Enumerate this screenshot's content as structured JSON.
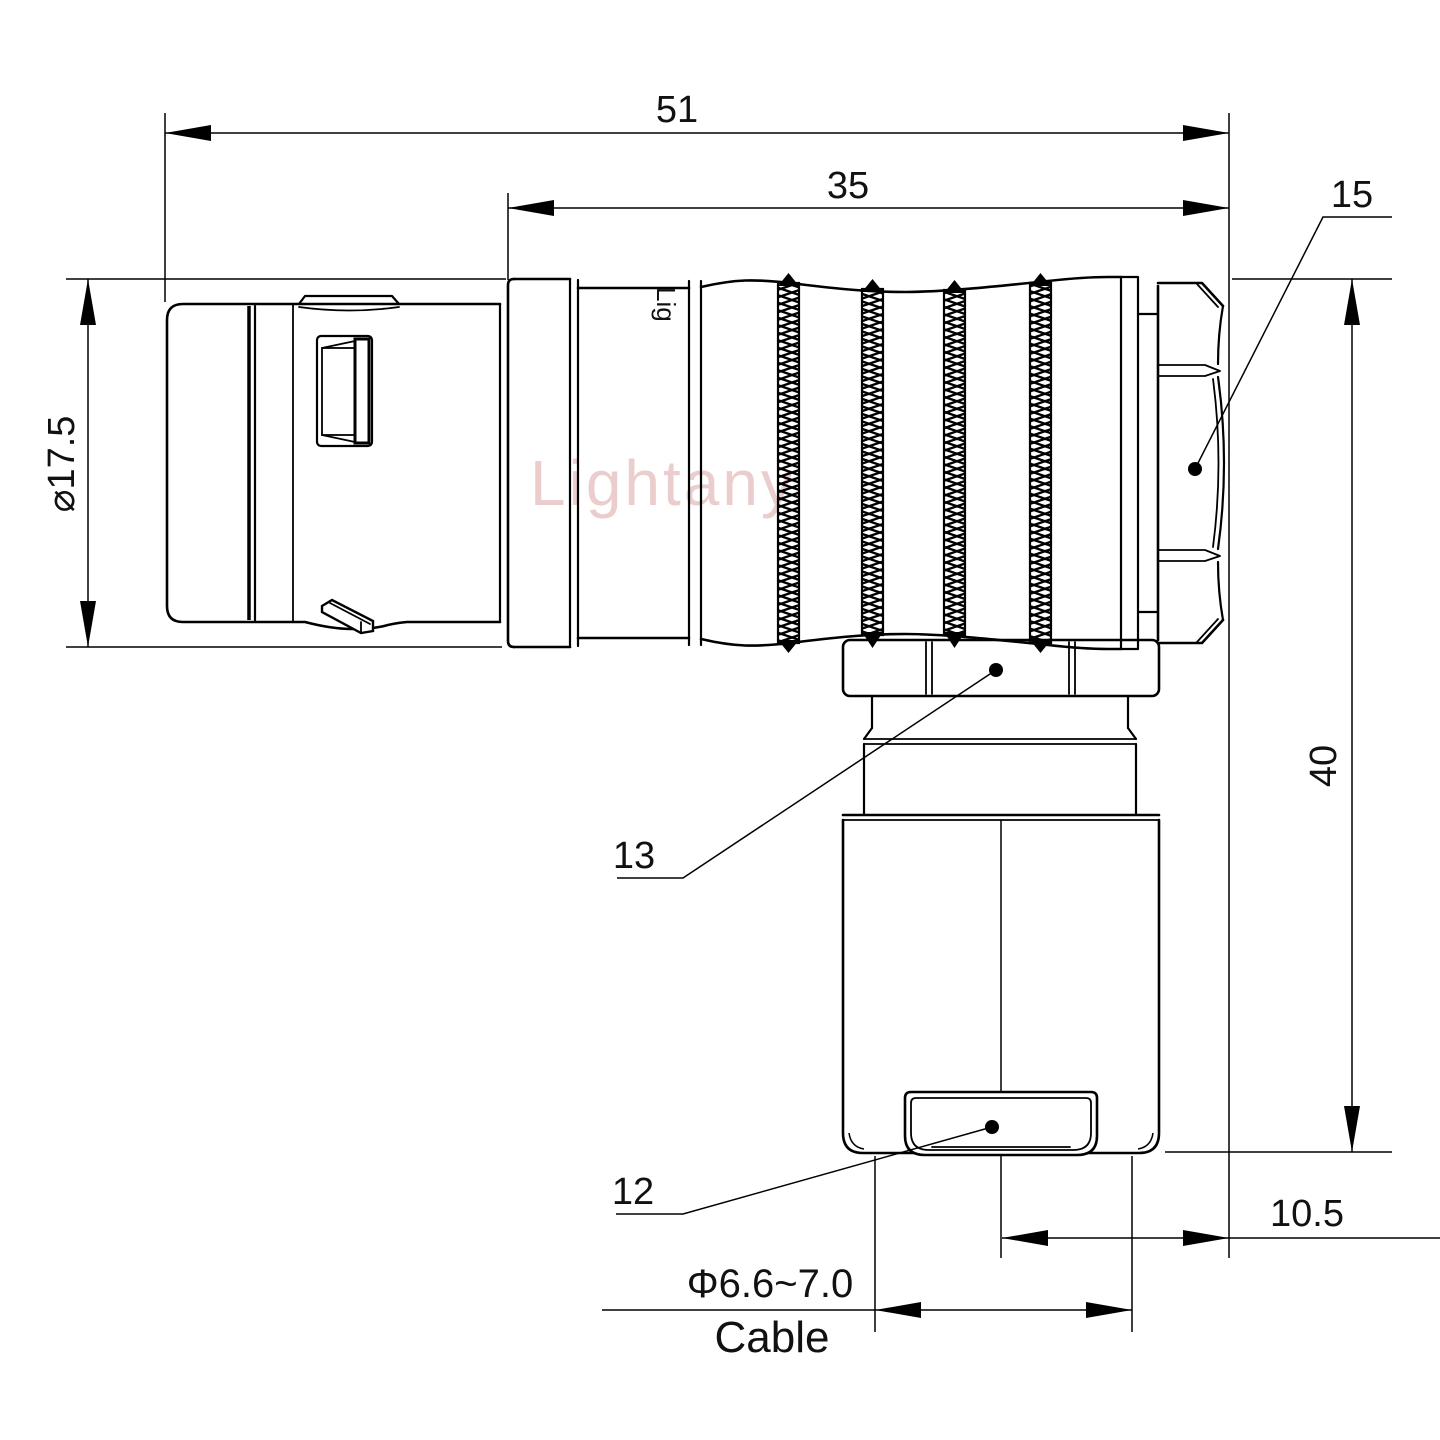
{
  "drawing": {
    "watermark": "Lightany",
    "part_marking": "Lig",
    "dimensions": {
      "overall_length": "51",
      "rear_length": "35",
      "shell_diameter": "⌀17.5",
      "height": "40",
      "axis_to_rear": "10.5",
      "cable_diameter": "Φ6.6~7.0",
      "cable_label": "Cable"
    },
    "callouts": {
      "backshell_nut": "15",
      "coupling_nut": "13",
      "cord_grip": "12"
    }
  }
}
